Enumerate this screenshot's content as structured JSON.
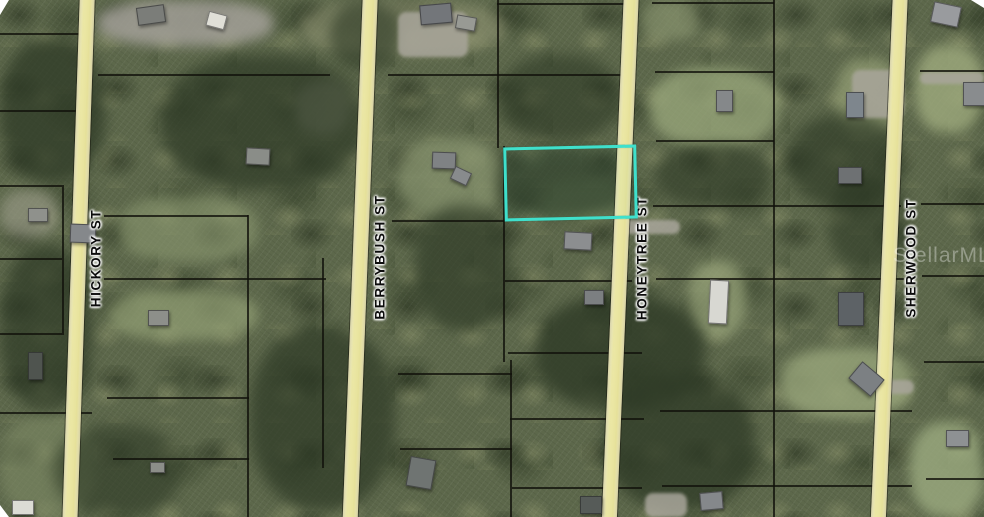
{
  "map": {
    "type": "aerial-parcel-map",
    "colors": {
      "highlight": "#3fe0cc",
      "road": "#ebe7a4",
      "parcel_line": "#11110b",
      "foliage_dark": "#2e3a26",
      "foliage_base": "#5d684b"
    },
    "watermark": {
      "text": "StellarMLS"
    },
    "streets": [
      {
        "name": "HICKORY ST",
        "top_x": 80,
        "tilt_deg": 1.9,
        "label_x": 96,
        "label_y": 258
      },
      {
        "name": "BERRYBUSH ST",
        "top_x": 363,
        "tilt_deg": 2.2,
        "label_x": 380,
        "label_y": 257
      },
      {
        "name": "HONEYTREE ST",
        "top_x": 624,
        "tilt_deg": 2.4,
        "label_x": 642,
        "label_y": 258
      },
      {
        "name": "SHERWOOD ST",
        "top_x": 893,
        "tilt_deg": 2.4,
        "label_x": 911,
        "label_y": 258
      }
    ],
    "highlighted_parcel": {
      "x": 504,
      "y": 146,
      "width": 127,
      "height": 68,
      "rotation_deg": -1.3
    },
    "parcel_lines": {
      "horizontal": [
        [
          0,
          33,
          86
        ],
        [
          0,
          110,
          90
        ],
        [
          98,
          74,
          232
        ],
        [
          388,
          74,
          243
        ],
        [
          497,
          3,
          136
        ],
        [
          652,
          2,
          122
        ],
        [
          0,
          185,
          62
        ],
        [
          0,
          258,
          62
        ],
        [
          0,
          333,
          62
        ],
        [
          0,
          412,
          92
        ],
        [
          104,
          215,
          144
        ],
        [
          104,
          278,
          222
        ],
        [
          107,
          397,
          142
        ],
        [
          113,
          458,
          136
        ],
        [
          392,
          220,
          112
        ],
        [
          398,
          373,
          114
        ],
        [
          400,
          448,
          112
        ],
        [
          505,
          280,
          127
        ],
        [
          508,
          352,
          134
        ],
        [
          510,
          418,
          134
        ],
        [
          512,
          487,
          130
        ],
        [
          655,
          71,
          119
        ],
        [
          656,
          140,
          118
        ],
        [
          653,
          205,
          248
        ],
        [
          656,
          278,
          248
        ],
        [
          660,
          410,
          252
        ],
        [
          662,
          485,
          250
        ],
        [
          920,
          70,
          64
        ],
        [
          921,
          203,
          63
        ],
        [
          922,
          275,
          62
        ],
        [
          924,
          361,
          60
        ],
        [
          926,
          478,
          58
        ]
      ],
      "vertical": [
        [
          62,
          185,
          150
        ],
        [
          247,
          215,
          302
        ],
        [
          322,
          258,
          210
        ],
        [
          497,
          0,
          148
        ],
        [
          503,
          146,
          216
        ],
        [
          510,
          360,
          157
        ],
        [
          773,
          0,
          517
        ]
      ]
    },
    "structures": [
      [
        137,
        6,
        26,
        16,
        "#7b7d79",
        -8
      ],
      [
        207,
        13,
        17,
        13,
        "#e0dfd7",
        15
      ],
      [
        246,
        148,
        22,
        15,
        "#8a8d88",
        3
      ],
      [
        420,
        4,
        30,
        18,
        "#73767a",
        -5
      ],
      [
        456,
        16,
        18,
        12,
        "#989a94",
        10
      ],
      [
        28,
        208,
        18,
        12,
        "#8f918c",
        0
      ],
      [
        70,
        224,
        24,
        17,
        "#85888b",
        2
      ],
      [
        148,
        310,
        19,
        14,
        "#8d8f8a",
        0
      ],
      [
        432,
        152,
        22,
        15,
        "#7f8284",
        2
      ],
      [
        452,
        169,
        16,
        12,
        "#888b8d",
        25
      ],
      [
        564,
        232,
        26,
        16,
        "#8c8e90",
        3
      ],
      [
        584,
        290,
        18,
        13,
        "#7c7f81",
        0
      ],
      [
        716,
        90,
        15,
        20,
        "#85888a",
        0
      ],
      [
        846,
        92,
        16,
        24,
        "#7e868d",
        0
      ],
      [
        932,
        4,
        26,
        19,
        "#999b9e",
        12
      ],
      [
        963,
        82,
        20,
        22,
        "#898c8e",
        0
      ],
      [
        709,
        280,
        17,
        42,
        "#d8d8d2",
        3
      ],
      [
        838,
        292,
        24,
        32,
        "#5d6266",
        0
      ],
      [
        838,
        167,
        22,
        15,
        "#6e7173",
        0
      ],
      [
        852,
        368,
        27,
        20,
        "#7c8083",
        40
      ],
      [
        946,
        430,
        21,
        15,
        "#8e9193",
        0
      ],
      [
        700,
        492,
        21,
        16,
        "#85888b",
        -5
      ],
      [
        408,
        458,
        24,
        28,
        "#6f7472",
        10
      ],
      [
        12,
        500,
        20,
        13,
        "#dcdcd5",
        0
      ],
      [
        28,
        352,
        13,
        26,
        "#4f544f",
        0
      ],
      [
        150,
        462,
        13,
        9,
        "#8c8e89",
        0
      ],
      [
        580,
        496,
        20,
        16,
        "#565b58",
        0
      ]
    ],
    "clearings": [
      [
        98,
        0,
        175,
        46,
        "#a3a098",
        0.85
      ],
      [
        295,
        80,
        55,
        55,
        "#989b85",
        0.7
      ],
      [
        300,
        0,
        205,
        55,
        "#8f9372",
        0.6
      ],
      [
        108,
        290,
        150,
        50,
        "#93a075",
        0.7
      ],
      [
        118,
        196,
        140,
        66,
        "#8b9870",
        0.6
      ],
      [
        0,
        190,
        58,
        48,
        "#9a9b88",
        0.65
      ],
      [
        398,
        138,
        105,
        80,
        "#8e9a74",
        0.65
      ],
      [
        650,
        68,
        128,
        78,
        "#9aa87c",
        0.75
      ],
      [
        915,
        45,
        69,
        88,
        "#9fab7e",
        0.8
      ],
      [
        836,
        58,
        64,
        78,
        "#96a177",
        0.7
      ],
      [
        688,
        260,
        58,
        78,
        "#98a47a",
        0.7
      ],
      [
        780,
        348,
        132,
        70,
        "#9aa77c",
        0.8
      ],
      [
        910,
        422,
        74,
        95,
        "#9cab80",
        0.8
      ],
      [
        0,
        415,
        95,
        102,
        "#7e8a65",
        0.6
      ],
      [
        540,
        180,
        90,
        40,
        "#7f8c63",
        0.5
      ],
      [
        640,
        0,
        60,
        40,
        "#8f9a74",
        0.6
      ]
    ],
    "tree_patches": [
      [
        0,
        38,
        105,
        145,
        0.75
      ],
      [
        160,
        55,
        205,
        135,
        0.7
      ],
      [
        496,
        148,
        136,
        70,
        0.65
      ],
      [
        535,
        295,
        170,
        115,
        0.8
      ],
      [
        250,
        325,
        145,
        185,
        0.7
      ],
      [
        415,
        205,
        95,
        125,
        0.65
      ],
      [
        655,
        145,
        115,
        62,
        0.6
      ],
      [
        788,
        115,
        115,
        92,
        0.65
      ],
      [
        0,
        245,
        92,
        165,
        0.7
      ],
      [
        828,
        175,
        80,
        95,
        0.6
      ],
      [
        605,
        375,
        150,
        135,
        0.75
      ],
      [
        55,
        425,
        125,
        92,
        0.6
      ],
      [
        330,
        0,
        70,
        70,
        0.6
      ],
      [
        500,
        55,
        120,
        85,
        0.6
      ]
    ],
    "pavement_patches": [
      [
        852,
        70,
        52,
        48
      ],
      [
        920,
        72,
        64,
        12
      ],
      [
        645,
        493,
        42,
        24
      ],
      [
        398,
        12,
        70,
        45
      ],
      [
        878,
        380,
        36,
        14
      ],
      [
        620,
        220,
        60,
        14
      ]
    ]
  }
}
